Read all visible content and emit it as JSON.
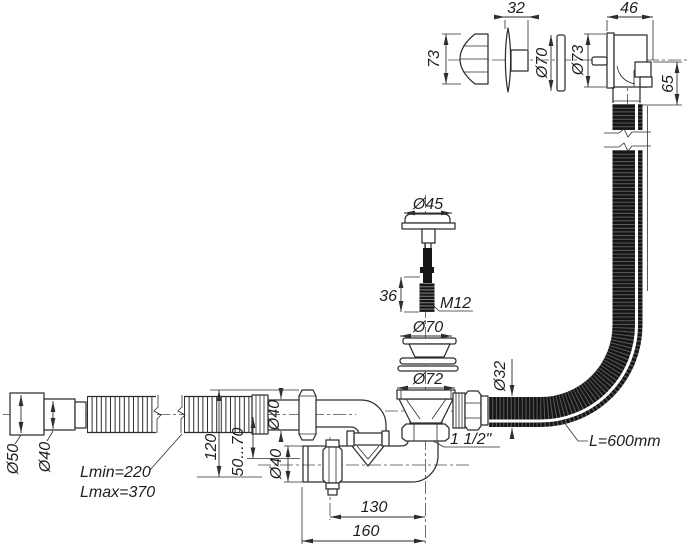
{
  "drawing": {
    "type": "technical-drawing",
    "subject": "bath siphon with overflow, exploded and assembled views"
  },
  "colors": {
    "line": "#2e2e2e",
    "hose_fill": "#161616",
    "background": "#ffffff"
  },
  "labels": {
    "knob_height": "73",
    "cover_depth": "32",
    "cover_plate_diameter": "Ø70",
    "overflow_flange_diameter": "Ø73",
    "overflow_body_width": "46",
    "overflow_outlet_height": "65",
    "plug_cap_diameter": "Ø45",
    "stud_length": "36",
    "stud_thread": "M12",
    "strainer_diameter": "Ø70",
    "seal_diameter": "Ø72",
    "overflow_hose_diameter": "Ø32",
    "overflow_hose_length": "L=600mm",
    "outlet_thread": "1 1/2\"",
    "hose_end_diameter": "Ø50",
    "hose_adapter_diameter": "Ø40",
    "inlet_pipe_diameter": "Ø40",
    "outlet_pipe_diameter": "Ø40",
    "inlet_height": "120",
    "adjustment_range": "50...70",
    "hose_min_length": "Lmin=220",
    "hose_max_length": "Lmax=370",
    "outlet_offset": "130",
    "overall_length": "160"
  }
}
